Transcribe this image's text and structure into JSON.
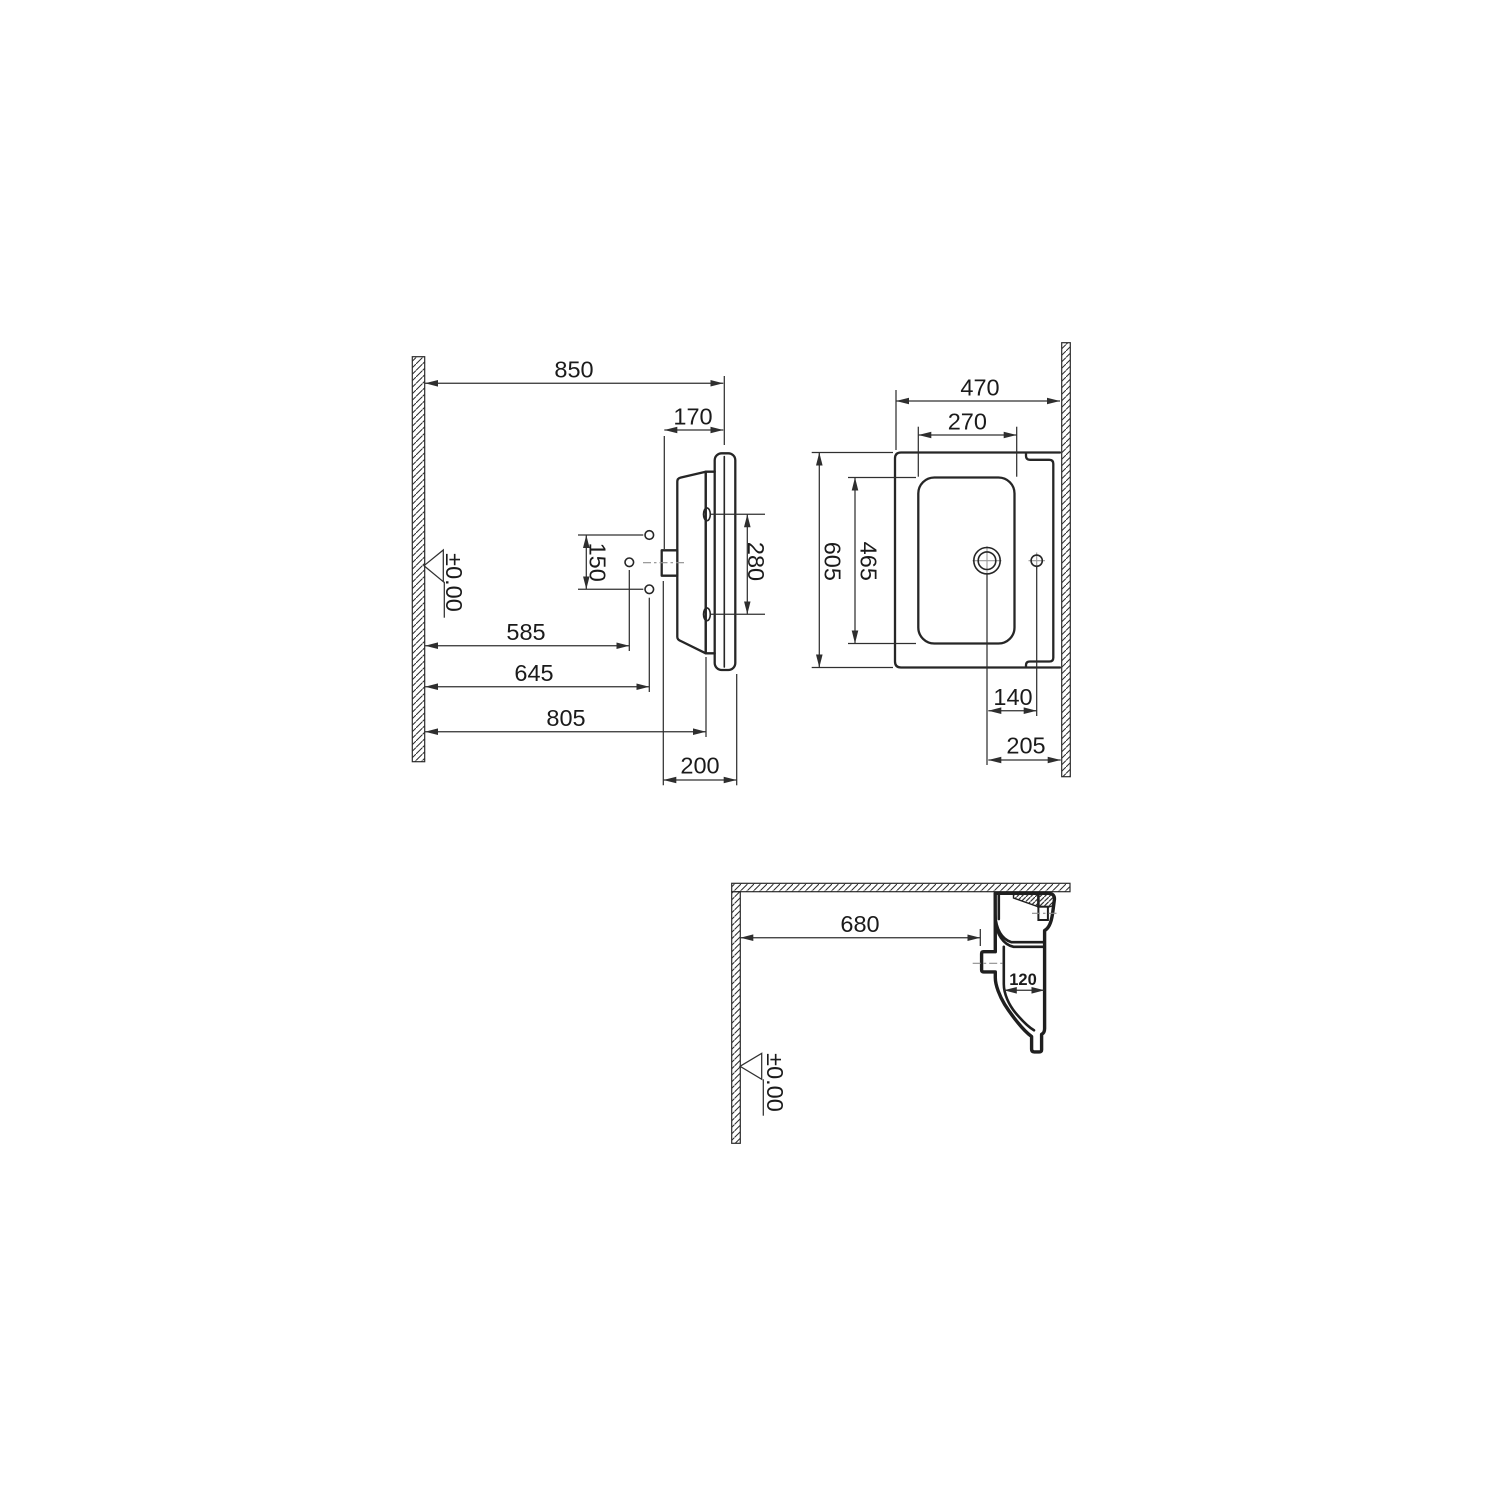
{
  "views": {
    "side": {
      "d850": "850",
      "d170": "170",
      "d150": "150",
      "d280": "280",
      "d585": "585",
      "d645": "645",
      "d805": "805",
      "d200": "200",
      "datum": "±0.00"
    },
    "plan": {
      "d470": "470",
      "d270": "270",
      "d605": "605",
      "d465": "465",
      "d140": "140",
      "d205": "205"
    },
    "section": {
      "d680": "680",
      "d120": "120",
      "datum": "±0.00"
    }
  }
}
